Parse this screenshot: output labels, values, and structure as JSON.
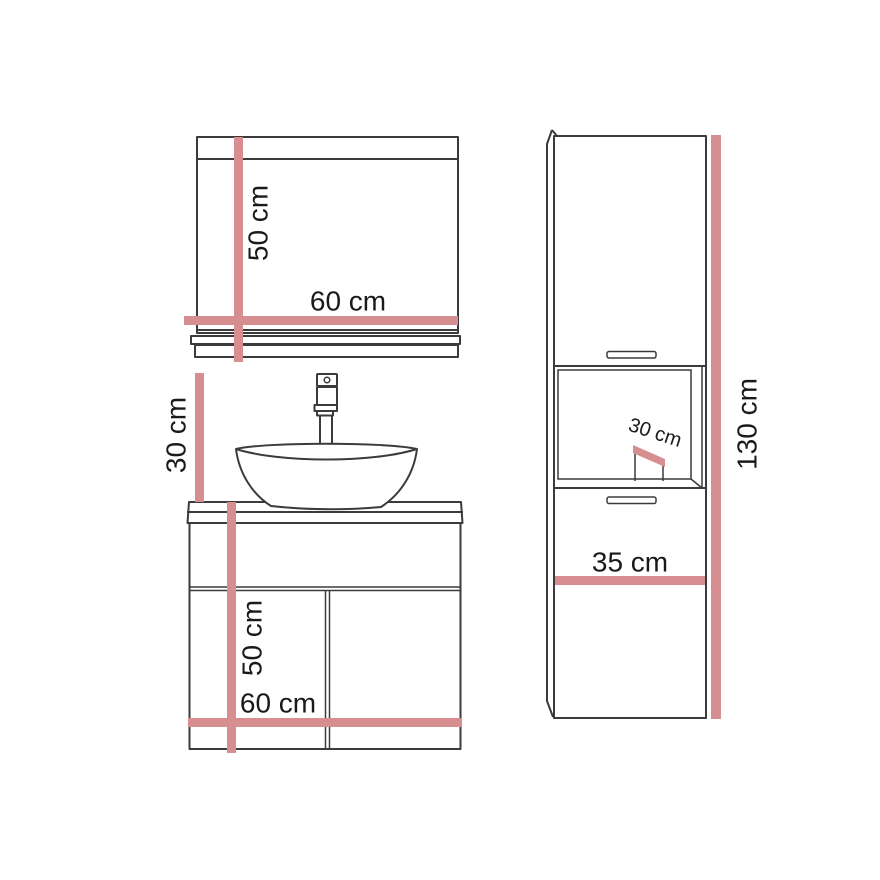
{
  "colors": {
    "dimension": "#d68e90",
    "outline": "#3b3b3b",
    "text": "#1a1a1a",
    "background": "#ffffff"
  },
  "labels": {
    "mirror": {
      "height": "50 cm",
      "width": "60 cm"
    },
    "vanity": {
      "basin_height": "30 cm",
      "cabinet_height": "50 cm",
      "width": "60 cm"
    },
    "tall_cabinet": {
      "depth": "30 cm",
      "width": "35 cm",
      "height": "130 cm"
    }
  }
}
